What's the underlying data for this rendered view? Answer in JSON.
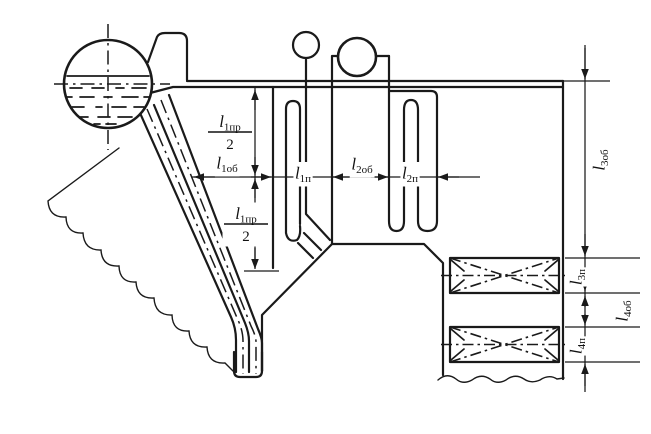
{
  "diagram": {
    "kind": "boiler-circulation-scheme",
    "colors": {
      "ink": "#1a1a1a",
      "background": "#ffffff"
    },
    "labels": [
      {
        "name": "dim-l1pr-over-2-upper",
        "type": "fraction",
        "base": "l",
        "sub": "1пр",
        "den": "2",
        "x": 230,
        "y": 132,
        "rot": 0
      },
      {
        "name": "dim-l1ob",
        "type": "plain",
        "base": "l",
        "sub": "1об",
        "x": 227,
        "y": 164,
        "rot": 0
      },
      {
        "name": "dim-l1pr-over-2-lower",
        "type": "fraction",
        "base": "l",
        "sub": "1пр",
        "den": "2",
        "x": 246,
        "y": 224,
        "rot": 0
      },
      {
        "name": "dim-l1p",
        "type": "plain",
        "base": "l",
        "sub": "1п",
        "x": 303,
        "y": 174,
        "rot": 0
      },
      {
        "name": "dim-l2ob",
        "type": "plain",
        "base": "l",
        "sub": "2об",
        "x": 362,
        "y": 165,
        "rot": 0
      },
      {
        "name": "dim-l2p",
        "type": "plain",
        "base": "l",
        "sub": "2п",
        "x": 410,
        "y": 174,
        "rot": 0
      },
      {
        "name": "dim-l3ob",
        "type": "plain",
        "base": "l",
        "sub": "3об",
        "x": 600,
        "y": 160,
        "rot": -90
      },
      {
        "name": "dim-l3p",
        "type": "plain",
        "base": "l",
        "sub": "3п",
        "x": 577,
        "y": 277,
        "rot": -90
      },
      {
        "name": "dim-l4ob",
        "type": "plain",
        "base": "l",
        "sub": "4об",
        "x": 623,
        "y": 311,
        "rot": -90
      },
      {
        "name": "dim-l4p",
        "type": "plain",
        "base": "l",
        "sub": "4п",
        "x": 577,
        "y": 346,
        "rot": -90
      }
    ]
  }
}
